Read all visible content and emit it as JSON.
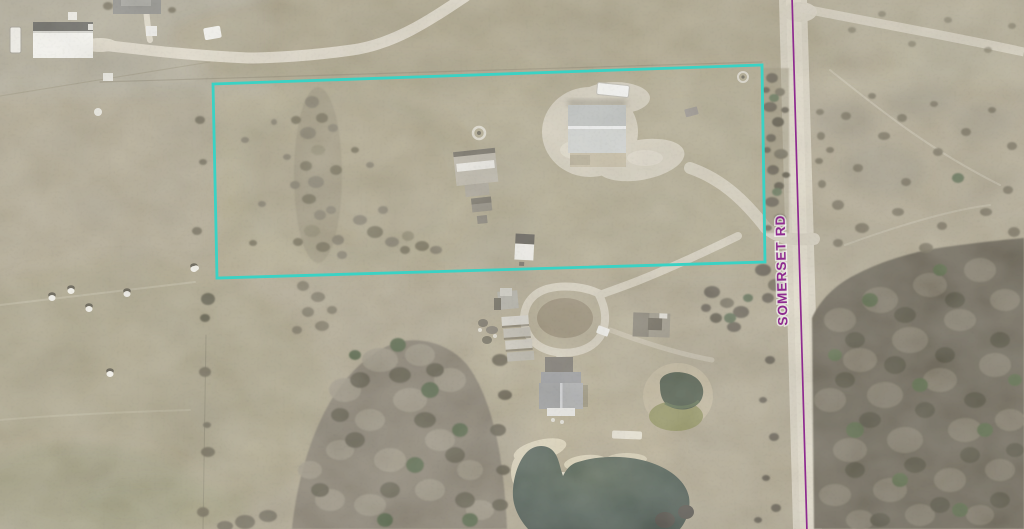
{
  "map": {
    "kind": "aerial-parcel-view",
    "road": {
      "label": "SOMERSET RD",
      "line_color": "#8e2b8f",
      "label_color": "#8e2b8f"
    },
    "parcel": {
      "boundary_color": "#3ad2c4",
      "boundary_points": "213,84 762,65 765,262 217,278"
    },
    "features": [
      "white-barn",
      "neighbor-house",
      "semi-trailer",
      "metal-workshop-building",
      "rv-trailer",
      "mobile-home",
      "fire-pit-ring",
      "storage-shed",
      "windmill-tower",
      "kennel-rows",
      "old-shed",
      "farm-house",
      "heart-shaped-pond",
      "small-pond",
      "hay-bales",
      "somerset-road",
      "gravel-driveways",
      "woodland",
      "pasture"
    ]
  }
}
